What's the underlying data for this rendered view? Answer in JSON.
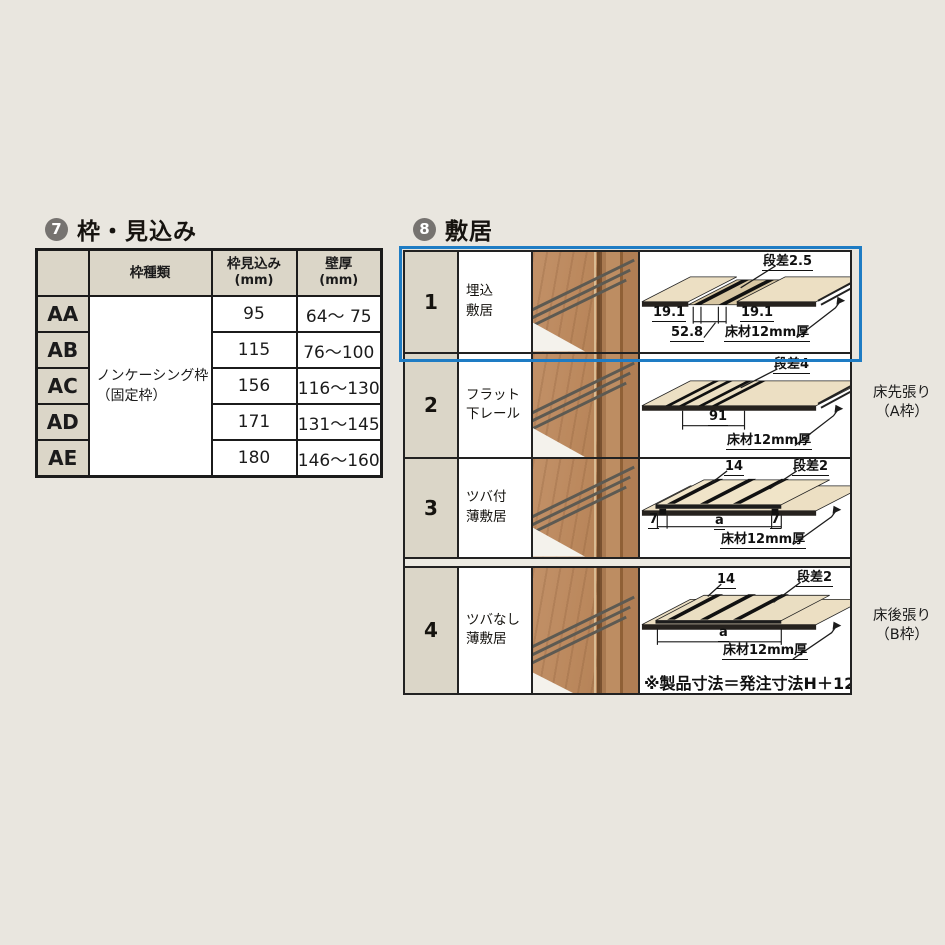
{
  "colors": {
    "page_bg": "#e9e6df",
    "highlight_blue": "#1e7cc4",
    "badge_gray": "#767370",
    "header_cell_beige": "#dbd6c8",
    "diagram_wood_cream": "#ecdfc3",
    "photo_wood_brown": "#b5835a"
  },
  "section7": {
    "number": "7",
    "title": "枠・見込み",
    "table": {
      "headers": {
        "corner": "",
        "type": "枠種類",
        "mikomi": "枠見込み",
        "mikomi_unit": "(mm)",
        "wall": "壁厚",
        "wall_unit": "(mm)"
      },
      "type_label_line1": "ノンケーシング枠",
      "type_label_line2": "（固定枠）",
      "rows": [
        {
          "code": "AA",
          "mikomi": "95",
          "wall": "64～ 75"
        },
        {
          "code": "AB",
          "mikomi": "115",
          "wall": "76～100"
        },
        {
          "code": "AC",
          "mikomi": "156",
          "wall": "116～130"
        },
        {
          "code": "AD",
          "mikomi": "171",
          "wall": "131～145"
        },
        {
          "code": "AE",
          "mikomi": "180",
          "wall": "146～160"
        }
      ]
    }
  },
  "section8": {
    "number": "8",
    "title": "敷居",
    "rows": [
      {
        "num": "1",
        "label_line1": "埋込",
        "label_line2": "敷居",
        "dims": {
          "step": "段差2.5",
          "d_left": "19.1",
          "d_right": "19.1",
          "d_total": "52.8",
          "floor": "床材12mm厚"
        }
      },
      {
        "num": "2",
        "label_line1": "フラット",
        "label_line2": "下レール",
        "dims": {
          "step": "段差4",
          "d_width": "91",
          "floor": "床材12mm厚"
        }
      },
      {
        "num": "3",
        "label_line1": "ツバ付",
        "label_line2": "薄敷居",
        "dims": {
          "top": "14",
          "step": "段差2",
          "left": "7",
          "center": "a",
          "right": "7",
          "floor": "床材12mm厚"
        }
      },
      {
        "num": "4",
        "label_line1": "ツバなし",
        "label_line2": "薄敷居",
        "dims": {
          "top": "14",
          "step": "段差2",
          "center": "a",
          "floor": "床材12mm厚"
        }
      }
    ],
    "side_labels": {
      "a_line1": "床先張り",
      "a_line2": "（A枠）",
      "b_line1": "床後張り",
      "b_line2": "（B枠）"
    },
    "note": "※製品寸法＝発注寸法H＋12"
  }
}
